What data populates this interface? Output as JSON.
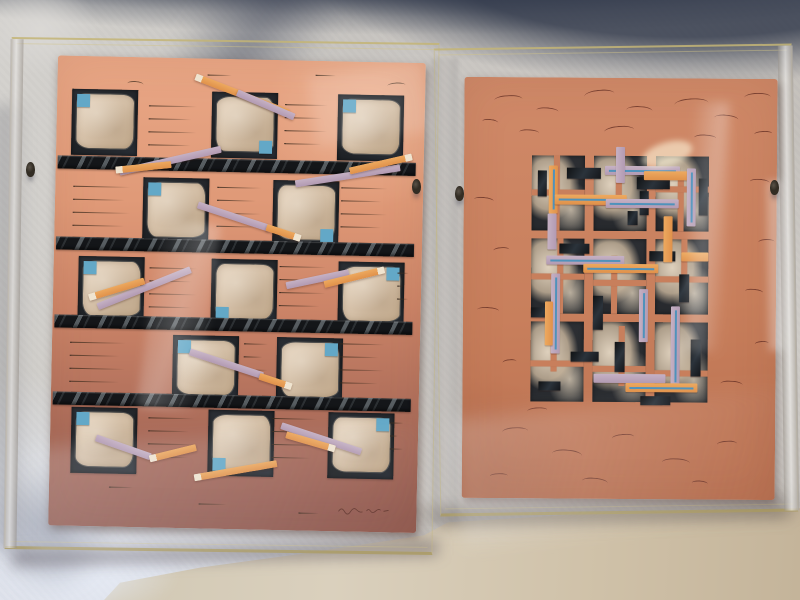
{
  "scene": {
    "description": "Photograph of two abstract mixed-media collage prints on handmade salmon/terracotta paper, each mounted in a clear acrylic box frame, leaning against a gray fabric drape on a beige table surface",
    "left_artwork_motif": "checkerboard grid of dark squares with torn cream mulberry-paper patches, small blue squares, four black diagonally-striped bars, scattered diagonal orange and lavender strips, rows of fine pen lines",
    "right_artwork_motif": "central rectangular lattice of dark panels with torn cream paper, overlaid with orange and lavender strips (some with thin blue center lines) and small black bars on terracotta paper covered with fine pen squiggles"
  },
  "colors": {
    "paperLTop": "#e9a786",
    "paperLMid": "#cd8568",
    "paperLLow": "#aa6b59",
    "paperLBot": "#935c52",
    "paperR1": "#d08a69",
    "paperR2": "#c87f5c",
    "paperR3": "#b97050",
    "cream1": "#e3d1bc",
    "cream2": "#d6c1a8",
    "cream3": "#ccb496",
    "blueSquare": "#63a8c7",
    "blueLine": "#4f92bb",
    "orange": "#e0914a",
    "orangeLight": "#eda95f",
    "creamTip": "#efe4d0",
    "lavender": "#b29ab2",
    "lavenderLight": "#c5b1c4",
    "barBlack": "#141619",
    "barStripe": "#8e979c",
    "penLeft": "#3e2c1e",
    "penRight": "#5d2a20",
    "acrylicEdge": "#c4b576",
    "clip": "#332d24",
    "fabric": "#c7c4c0",
    "drapeShadow": "#343c4e",
    "floor": "#d2c9b5"
  },
  "frames": {
    "left": {
      "x": 8,
      "y": 40,
      "w": 428,
      "h": 512,
      "rot": 0.8
    },
    "right": {
      "x": 437,
      "y": 46,
      "w": 358,
      "h": 468,
      "rot": -0.8
    },
    "clips": [
      {
        "x": 26,
        "y": 162
      },
      {
        "x": 412,
        "y": 179
      },
      {
        "x": 455,
        "y": 186
      },
      {
        "x": 770,
        "y": 180
      }
    ]
  },
  "left_artwork": {
    "paper": {
      "x": 44,
      "y": 17,
      "w": 368,
      "h": 470,
      "rot": 0.4
    },
    "square_size": 66,
    "bar_height": 13,
    "bars_y": [
      100,
      181,
      259,
      336
    ],
    "rows": [
      {
        "y": 33,
        "squares": [
          {
            "x": 15,
            "b": "tl"
          },
          {
            "x": 155,
            "b": "br"
          },
          {
            "x": 281,
            "b": "tl"
          }
        ]
      },
      {
        "y": 120,
        "squares": [
          {
            "x": 88,
            "b": "tl"
          },
          {
            "x": 218,
            "b": "br"
          }
        ]
      },
      {
        "y": 200,
        "squares": [
          {
            "x": 25,
            "b": "tl"
          },
          {
            "x": 158,
            "b": "bl"
          },
          {
            "x": 285,
            "b": "tr"
          }
        ]
      },
      {
        "y": 277,
        "squares": [
          {
            "x": 121,
            "b": "tl"
          },
          {
            "x": 225,
            "b": "tr"
          }
        ]
      },
      {
        "y": 351,
        "squares": [
          {
            "x": 21,
            "b": "tl"
          },
          {
            "x": 158,
            "b": "bl"
          },
          {
            "x": 278,
            "b": "tr"
          }
        ]
      }
    ],
    "strips": [
      {
        "x": 138,
        "y": 15,
        "len": 100,
        "ang": 20,
        "c": "orange",
        "tip": "start"
      },
      {
        "x": 180,
        "y": 30,
        "len": 62,
        "ang": 22,
        "c": "lavender"
      },
      {
        "x": 64,
        "y": 112,
        "len": 104,
        "ang": -14,
        "c": "lavender"
      },
      {
        "x": 60,
        "y": 110,
        "len": 56,
        "ang": -7,
        "c": "orange",
        "tip": "start"
      },
      {
        "x": 240,
        "y": 120,
        "len": 106,
        "ang": -10,
        "c": "lavender"
      },
      {
        "x": 294,
        "y": 106,
        "len": 64,
        "ang": -14,
        "c": "orange",
        "tip": "end"
      },
      {
        "x": 143,
        "y": 143,
        "len": 76,
        "ang": 17,
        "c": "lavender"
      },
      {
        "x": 212,
        "y": 164,
        "len": 36,
        "ang": 17,
        "c": "orange",
        "tip": "end"
      },
      {
        "x": 45,
        "y": 247,
        "len": 100,
        "ang": -23,
        "c": "lavender"
      },
      {
        "x": 36,
        "y": 238,
        "len": 58,
        "ang": -18,
        "c": "orange",
        "tip": "start"
      },
      {
        "x": 233,
        "y": 222,
        "len": 64,
        "ang": -13,
        "c": "lavender"
      },
      {
        "x": 271,
        "y": 220,
        "len": 62,
        "ang": -15,
        "c": "orange",
        "tip": "end"
      },
      {
        "x": 138,
        "y": 290,
        "len": 77,
        "ang": 17,
        "c": "lavender"
      },
      {
        "x": 208,
        "y": 313,
        "len": 34,
        "ang": 17,
        "c": "orange",
        "tip": "end"
      },
      {
        "x": 46,
        "y": 378,
        "len": 58,
        "ang": 18,
        "c": "lavender"
      },
      {
        "x": 100,
        "y": 398,
        "len": 48,
        "ang": -15,
        "c": "orange",
        "tip": "start"
      },
      {
        "x": 145,
        "y": 416,
        "len": 84,
        "ang": -11,
        "c": "orange",
        "tip": "start"
      },
      {
        "x": 231,
        "y": 362,
        "len": 84,
        "ang": 17,
        "c": "lavender"
      },
      {
        "x": 236,
        "y": 371,
        "len": 51,
        "ang": 15,
        "c": "orange",
        "tip": "end"
      }
    ],
    "pen_line_groups": [
      {
        "x": 92,
        "y": 48,
        "w": 52,
        "n": 4
      },
      {
        "x": 228,
        "y": 44,
        "w": 46,
        "n": 4
      },
      {
        "x": 18,
        "y": 130,
        "w": 62,
        "n": 4
      },
      {
        "x": 162,
        "y": 128,
        "w": 48,
        "n": 4
      },
      {
        "x": 286,
        "y": 126,
        "w": 50,
        "n": 4
      },
      {
        "x": 96,
        "y": 210,
        "w": 52,
        "n": 4
      },
      {
        "x": 226,
        "y": 206,
        "w": 50,
        "n": 4
      },
      {
        "x": 344,
        "y": 210,
        "w": 12,
        "n": 3
      },
      {
        "x": 18,
        "y": 286,
        "w": 60,
        "n": 4
      },
      {
        "x": 192,
        "y": 284,
        "w": 26,
        "n": 3
      },
      {
        "x": 288,
        "y": 282,
        "w": 48,
        "n": 4
      },
      {
        "x": 98,
        "y": 360,
        "w": 50,
        "n": 4
      },
      {
        "x": 222,
        "y": 358,
        "w": 48,
        "n": 4
      },
      {
        "x": 340,
        "y": 360,
        "w": 14,
        "n": 3
      },
      {
        "x": 60,
        "y": 430,
        "w": 26,
        "n": 1
      },
      {
        "x": 150,
        "y": 445,
        "w": 30,
        "n": 1
      },
      {
        "x": 250,
        "y": 452,
        "w": 22,
        "n": 1
      },
      {
        "x": 150,
        "y": 16,
        "w": 26,
        "n": 1
      },
      {
        "x": 258,
        "y": 14,
        "w": 22,
        "n": 1
      }
    ],
    "stray_marks": [
      {
        "x": 330,
        "y": 20,
        "w": 18,
        "r": -4
      },
      {
        "x": 70,
        "y": 24,
        "w": 16,
        "r": 3
      }
    ],
    "signature": "illegible cursive artist signature with date, lower right corner"
  },
  "right_artwork": {
    "paper": {
      "x": 25,
      "y": 30,
      "w": 313,
      "h": 421,
      "rot": 1.2
    },
    "motif": {
      "x": 68,
      "y": 78,
      "w": 177,
      "h": 246
    },
    "panels": [
      {
        "x": 0,
        "y": 0,
        "w": 53,
        "h": 75
      },
      {
        "x": 62,
        "y": 0,
        "w": 53,
        "h": 75
      },
      {
        "x": 124,
        "y": 0,
        "w": 53,
        "h": 75
      },
      {
        "x": 0,
        "y": 83,
        "w": 53,
        "h": 75
      },
      {
        "x": 62,
        "y": 83,
        "w": 53,
        "h": 75
      },
      {
        "x": 124,
        "y": 83,
        "w": 53,
        "h": 75
      },
      {
        "x": 0,
        "y": 166,
        "w": 53,
        "h": 80
      },
      {
        "x": 62,
        "y": 166,
        "w": 53,
        "h": 80
      },
      {
        "x": 124,
        "y": 166,
        "w": 53,
        "h": 80
      }
    ],
    "inner_lines": [
      {
        "x": 22,
        "y": 0,
        "w": 6,
        "h": 75
      },
      {
        "x": 0,
        "y": 34,
        "w": 53,
        "h": 6
      },
      {
        "x": 84,
        "y": 0,
        "w": 6,
        "h": 40
      },
      {
        "x": 62,
        "y": 44,
        "w": 53,
        "h": 6
      },
      {
        "x": 146,
        "y": 20,
        "w": 6,
        "h": 55
      },
      {
        "x": 124,
        "y": 30,
        "w": 53,
        "h": 6
      },
      {
        "x": 26,
        "y": 83,
        "w": 6,
        "h": 75
      },
      {
        "x": 0,
        "y": 118,
        "w": 53,
        "h": 6
      },
      {
        "x": 80,
        "y": 100,
        "w": 6,
        "h": 58
      },
      {
        "x": 62,
        "y": 124,
        "w": 53,
        "h": 6
      },
      {
        "x": 150,
        "y": 83,
        "w": 6,
        "h": 40
      },
      {
        "x": 124,
        "y": 120,
        "w": 53,
        "h": 6
      },
      {
        "x": 20,
        "y": 166,
        "w": 6,
        "h": 50
      },
      {
        "x": 0,
        "y": 205,
        "w": 53,
        "h": 6
      },
      {
        "x": 88,
        "y": 170,
        "w": 6,
        "h": 60
      },
      {
        "x": 62,
        "y": 210,
        "w": 53,
        "h": 6
      },
      {
        "x": 142,
        "y": 180,
        "w": 6,
        "h": 45
      },
      {
        "x": 124,
        "y": 214,
        "w": 53,
        "h": 6
      }
    ],
    "black_bars": [
      {
        "x": 6,
        "y": 15,
        "w": 9,
        "h": 26
      },
      {
        "x": 35,
        "y": 12,
        "w": 34,
        "h": 11
      },
      {
        "x": 105,
        "y": 21,
        "w": 33,
        "h": 12
      },
      {
        "x": 108,
        "y": 35,
        "w": 9,
        "h": 24
      },
      {
        "x": 167,
        "y": 22,
        "w": 9,
        "h": 37
      },
      {
        "x": 96,
        "y": 55,
        "w": 10,
        "h": 14
      },
      {
        "x": 28,
        "y": 88,
        "w": 30,
        "h": 10
      },
      {
        "x": 118,
        "y": 95,
        "w": 26,
        "h": 10
      },
      {
        "x": 62,
        "y": 140,
        "w": 10,
        "h": 34
      },
      {
        "x": 0,
        "y": 152,
        "w": 24,
        "h": 10
      },
      {
        "x": 148,
        "y": 118,
        "w": 10,
        "h": 28
      },
      {
        "x": 160,
        "y": 183,
        "w": 10,
        "h": 37
      },
      {
        "x": 40,
        "y": 196,
        "w": 28,
        "h": 10
      },
      {
        "x": 110,
        "y": 240,
        "w": 30,
        "h": 9
      },
      {
        "x": 84,
        "y": 186,
        "w": 10,
        "h": 30
      },
      {
        "x": 8,
        "y": 226,
        "w": 22,
        "h": 9
      }
    ],
    "strips": [
      {
        "x": 17,
        "y": 10,
        "w": 9,
        "h": 48,
        "c": "orange",
        "v": 1,
        "line": 1
      },
      {
        "x": 16,
        "y": 58,
        "w": 9,
        "h": 36,
        "c": "lavender",
        "v": 1
      },
      {
        "x": 73,
        "y": 10,
        "w": 75,
        "h": 9,
        "c": "lavender",
        "line": 1
      },
      {
        "x": 112,
        "y": 15,
        "w": 44,
        "h": 9,
        "c": "orange"
      },
      {
        "x": 23,
        "y": 39,
        "w": 72,
        "h": 10,
        "c": "orange",
        "line": 1
      },
      {
        "x": 74,
        "y": 43,
        "w": 73,
        "h": 9,
        "c": "lavender",
        "line": 1
      },
      {
        "x": 155,
        "y": 12,
        "w": 9,
        "h": 58,
        "c": "lavender",
        "v": 1,
        "line": 1
      },
      {
        "x": 84,
        "y": -9,
        "w": 9,
        "h": 36,
        "c": "lavender",
        "v": 1
      },
      {
        "x": 132,
        "y": 60,
        "w": 9,
        "h": 46,
        "c": "orange",
        "v": 1
      },
      {
        "x": 15,
        "y": 100,
        "w": 78,
        "h": 9,
        "c": "lavender",
        "line": 1
      },
      {
        "x": 52,
        "y": 108,
        "w": 75,
        "h": 9,
        "c": "orange",
        "line": 1
      },
      {
        "x": 20,
        "y": 118,
        "w": 9,
        "h": 80,
        "c": "lavender",
        "v": 1,
        "line": 1
      },
      {
        "x": 14,
        "y": 146,
        "w": 8,
        "h": 44,
        "c": "orange",
        "v": 1
      },
      {
        "x": 108,
        "y": 133,
        "w": 9,
        "h": 53,
        "c": "lavender",
        "v": 1,
        "line": 1
      },
      {
        "x": 140,
        "y": 150,
        "w": 9,
        "h": 80,
        "c": "lavender",
        "v": 1,
        "line": 1
      },
      {
        "x": 63,
        "y": 218,
        "w": 72,
        "h": 9,
        "c": "lavender"
      },
      {
        "x": 95,
        "y": 227,
        "w": 72,
        "h": 9,
        "c": "orange",
        "line": 1
      },
      {
        "x": 150,
        "y": 96,
        "w": 27,
        "h": 9,
        "c": "orange"
      }
    ],
    "pen_marks": [
      {
        "x": 30,
        "y": 18,
        "w": 28,
        "r": -3
      },
      {
        "x": 72,
        "y": 30,
        "w": 22,
        "r": 4
      },
      {
        "x": 120,
        "y": 12,
        "w": 30,
        "r": -6
      },
      {
        "x": 162,
        "y": 28,
        "w": 26,
        "r": 2
      },
      {
        "x": 210,
        "y": 20,
        "w": 34,
        "r": -4
      },
      {
        "x": 250,
        "y": 36,
        "w": 24,
        "r": 5
      },
      {
        "x": 280,
        "y": 14,
        "w": 26,
        "r": -2
      },
      {
        "x": 55,
        "y": 52,
        "w": 20,
        "r": 3
      },
      {
        "x": 140,
        "y": 48,
        "w": 30,
        "r": -5
      },
      {
        "x": 230,
        "y": 56,
        "w": 22,
        "r": 2
      },
      {
        "x": 18,
        "y": 42,
        "w": 16,
        "r": 6
      },
      {
        "x": 290,
        "y": 52,
        "w": 18,
        "r": -3
      },
      {
        "x": 10,
        "y": 120,
        "w": 20,
        "r": 5
      },
      {
        "x": 30,
        "y": 170,
        "w": 16,
        "r": -4
      },
      {
        "x": 14,
        "y": 230,
        "w": 22,
        "r": 3
      },
      {
        "x": 40,
        "y": 282,
        "w": 14,
        "r": -6
      },
      {
        "x": 286,
        "y": 100,
        "w": 20,
        "r": 4
      },
      {
        "x": 295,
        "y": 160,
        "w": 16,
        "r": -2
      },
      {
        "x": 282,
        "y": 210,
        "w": 18,
        "r": 5
      },
      {
        "x": 292,
        "y": 262,
        "w": 14,
        "r": -4
      },
      {
        "x": 258,
        "y": 302,
        "w": 22,
        "r": 3
      },
      {
        "x": 40,
        "y": 350,
        "w": 26,
        "r": -3
      },
      {
        "x": 90,
        "y": 372,
        "w": 30,
        "r": 4
      },
      {
        "x": 150,
        "y": 356,
        "w": 22,
        "r": -5
      },
      {
        "x": 200,
        "y": 380,
        "w": 28,
        "r": 2
      },
      {
        "x": 255,
        "y": 362,
        "w": 20,
        "r": -3
      },
      {
        "x": 120,
        "y": 400,
        "w": 26,
        "r": 5
      },
      {
        "x": 28,
        "y": 396,
        "w": 18,
        "r": -2
      },
      {
        "x": 230,
        "y": 402,
        "w": 16,
        "r": 3
      },
      {
        "x": 65,
        "y": 330,
        "w": 20,
        "r": -4
      }
    ]
  }
}
